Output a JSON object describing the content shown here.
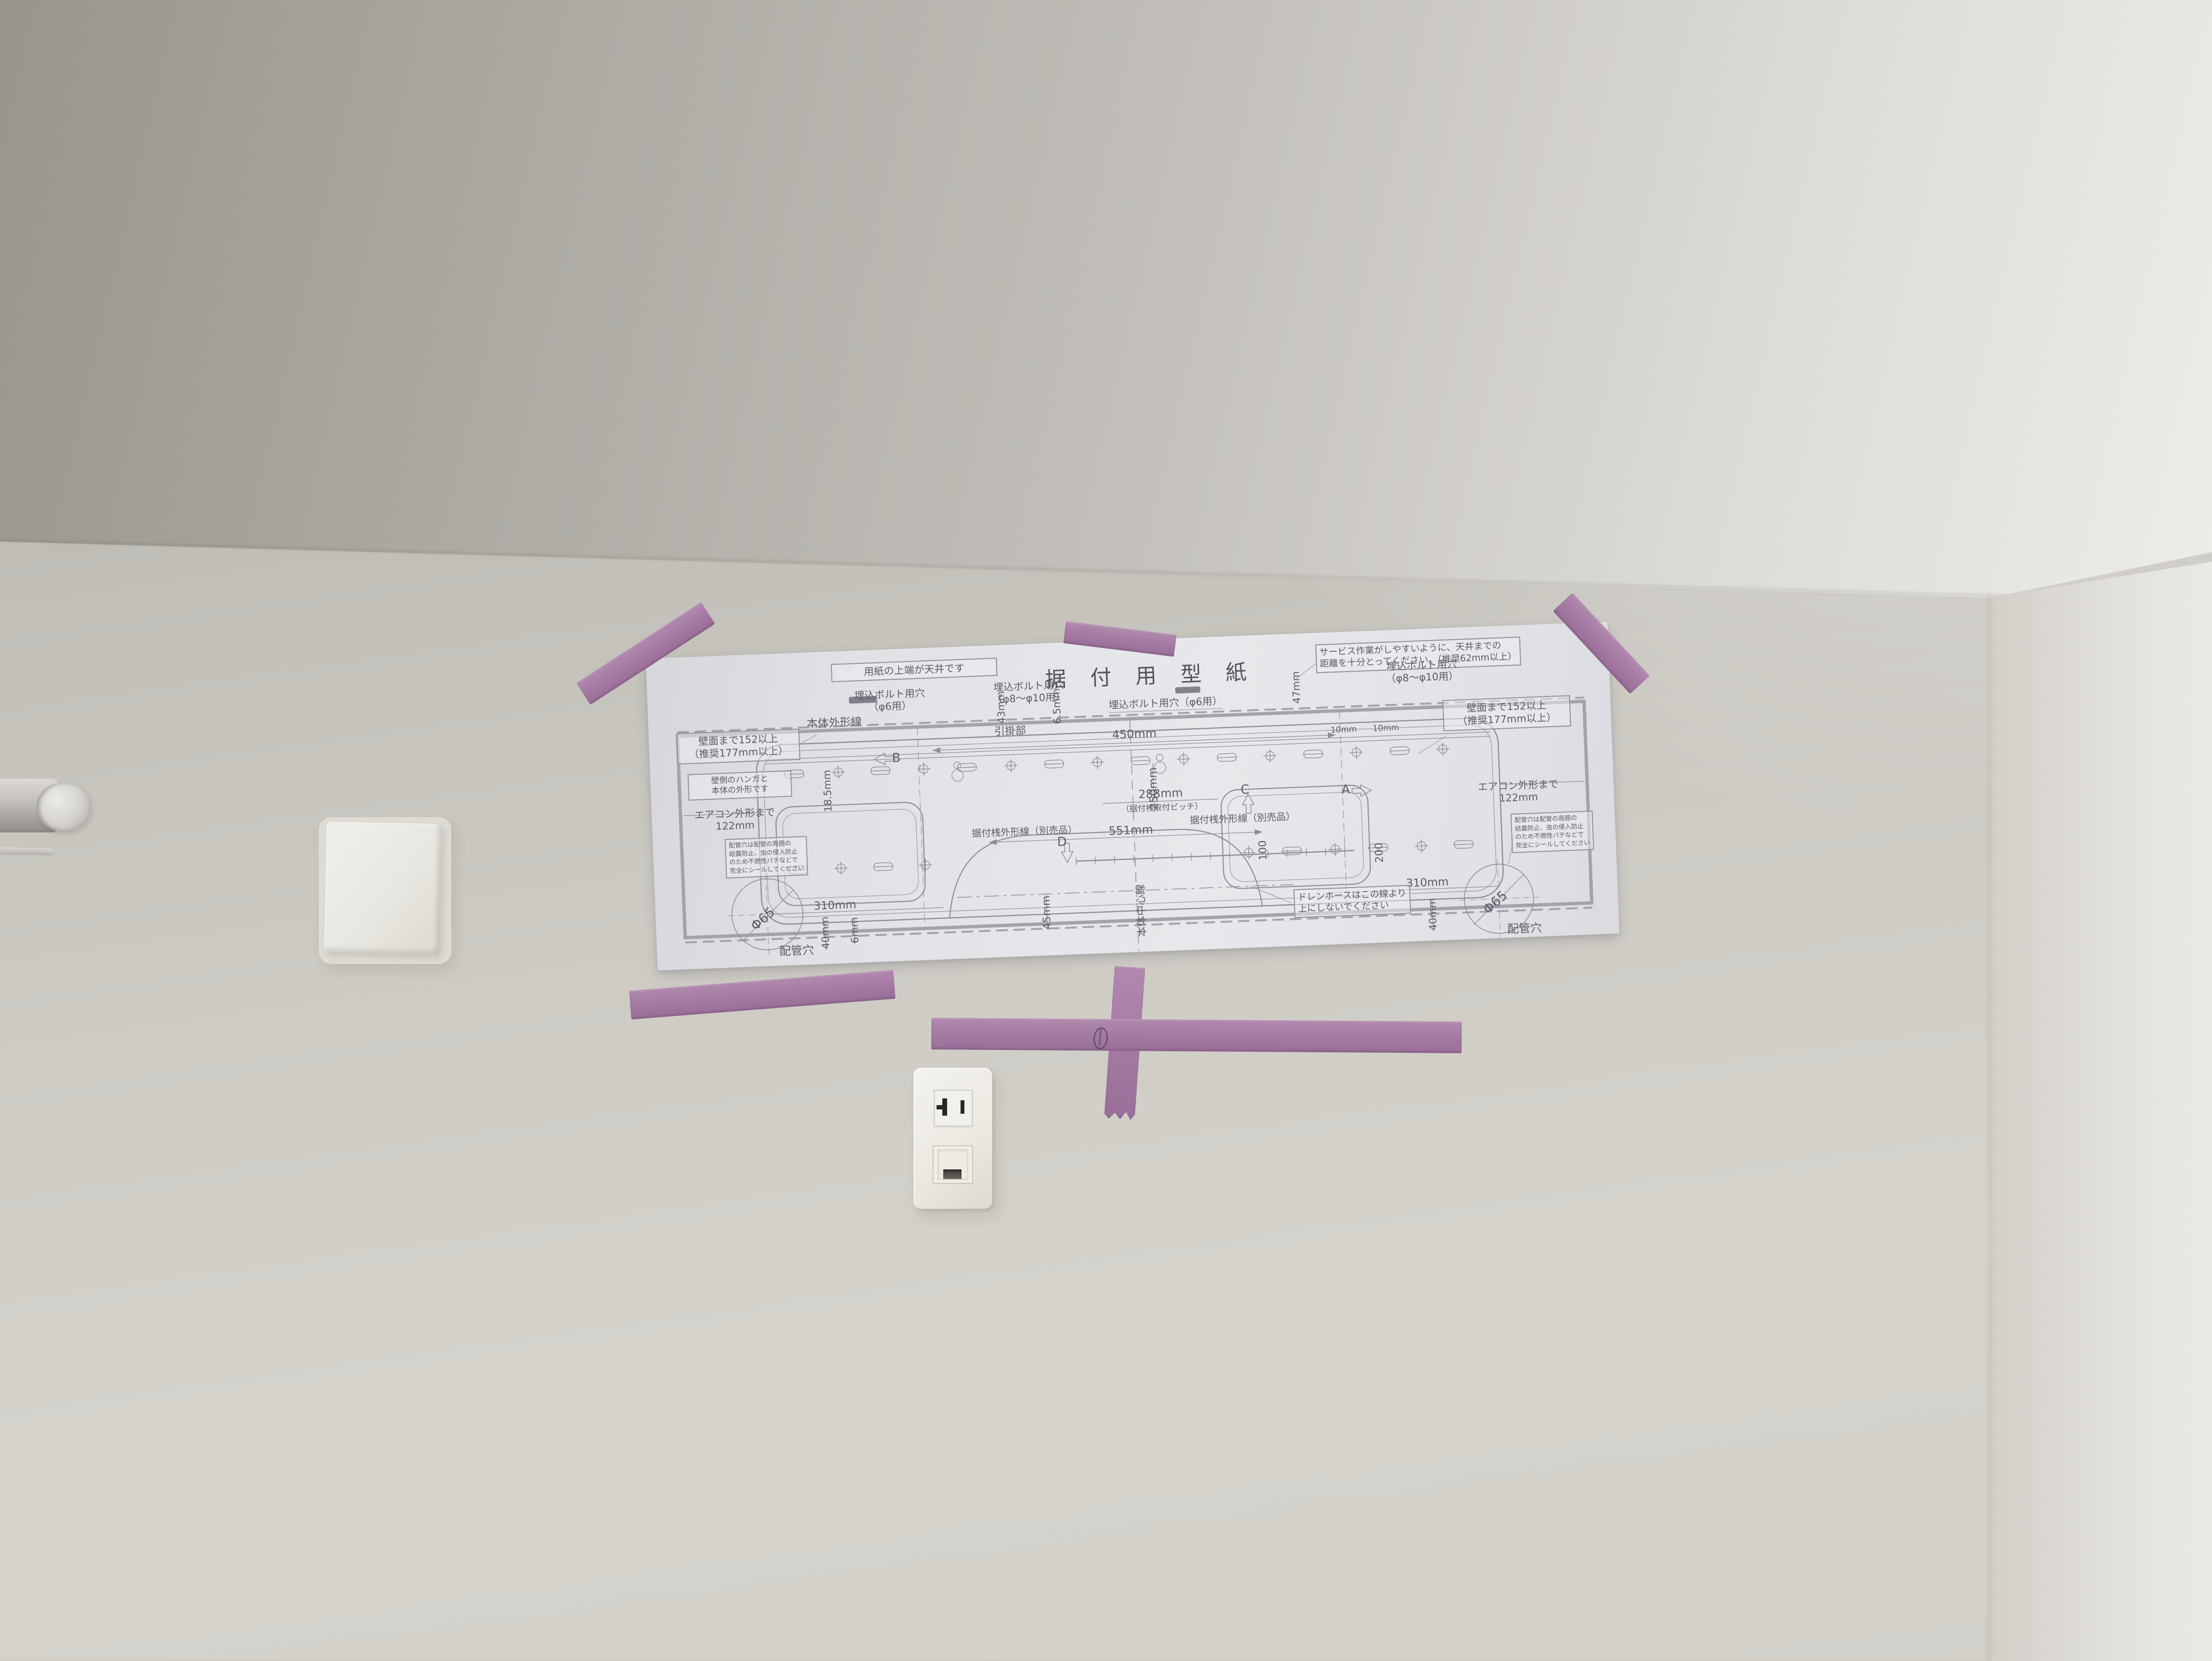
{
  "colors": {
    "wall": "#cdcac4",
    "ceiling_dark": "#98958f",
    "ceiling_light": "#eeece9",
    "paper": "#e3e4e8",
    "tape": "#a77da5",
    "print": "#5c5c66",
    "outlet": "#ece9e3"
  },
  "paper": {
    "title": "据 付 用 型 紙",
    "note_top": "用紙の上端が天井です",
    "service_note_1": "サービス作業がしやすいように、天井までの",
    "service_note_2": "距離を十分とってください。（推奨62mm以上）",
    "body_outline": "本体外形線",
    "hook": "引掛部",
    "bolt_hole": "埋込ボルト用穴",
    "bolt_hole_6_sub": "（φ6用）",
    "bolt_hole_810_sub": "（φ8〜φ10用）",
    "bolt_hole_6_inline": "埋込ボルト用穴（φ6用）",
    "wall_clearance_1": "壁面まで152以上",
    "wall_clearance_2": "（推奨177mm以上）",
    "hanger_note_1": "壁側のハンガと",
    "hanger_note_2": "本体の外形です",
    "dim_43": "43mm",
    "dim_65": "6.5mm",
    "dim_185": "18.5mm",
    "dim_47": "47mm",
    "dim_450": "450mm",
    "dim_250": "250mm",
    "dim_288": "288mm",
    "pitch_note": "（据付桟取付ピッチ）",
    "dim_551": "551mm",
    "rail_outline": "据付桟外形線（別売品）",
    "dim_45": "45mm",
    "center_line": "本体中心線",
    "drain_note_1": "ドレンホースはこの線より",
    "drain_note_2": "上にしないでください",
    "dim_100": "100",
    "dim_200": "200",
    "dim_310": "310mm",
    "phi65": "Φ65",
    "pipe_hole": "配管穴",
    "dim_40": "40mm",
    "dim_6": "6mm",
    "dim_10": "10mm",
    "aircon_outline_1": "エアコン外形まで",
    "aircon_outline_2": "122mm",
    "seal_1": "配管穴は配管の周囲の",
    "seal_2": "結露防止、虫の侵入防止",
    "seal_3": "のため不燃性パテなどで",
    "seal_4": "完全にシールしてください",
    "mark_a": "A",
    "mark_b": "B",
    "mark_c": "C",
    "mark_d": "D"
  }
}
